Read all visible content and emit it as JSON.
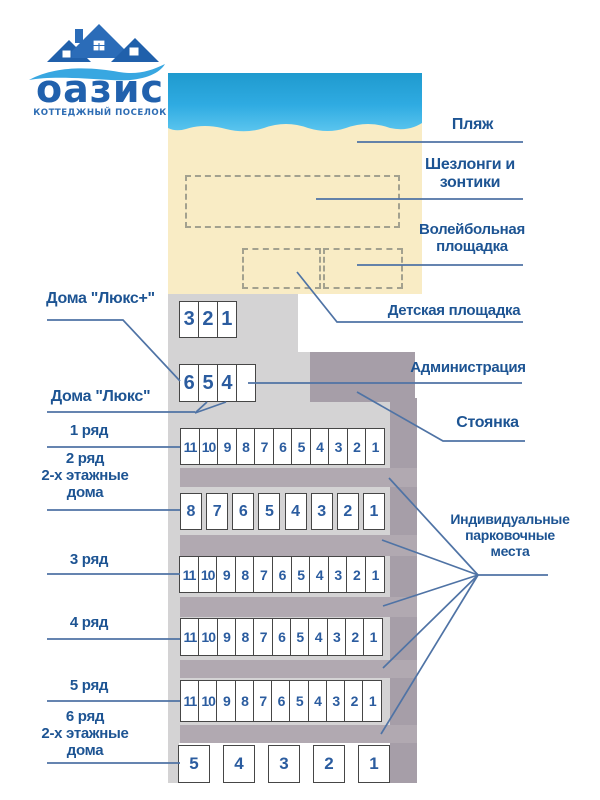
{
  "logo": {
    "brand": "оазис",
    "tagline": "КОТТЕДЖНЫЙ ПОСЕЛОК"
  },
  "legend_right": {
    "beach": "Пляж",
    "loungers": "Шезлонги и\nзонтики",
    "volleyball": "Волейбольная\nплощадка",
    "playground": "Детская площадка",
    "administration": "Администрация",
    "parking": "Стоянка",
    "individual_parking": "Индивидуальные\nпарковочные\nместа"
  },
  "legend_left": {
    "lux_plus": "Дома \"Люкс+\"",
    "lux": "Дома \"Люкс\"",
    "row1": "1 ряд",
    "row2": "2 ряд\n2-х этажные\nдома",
    "row3": "3 ряд",
    "row4": "4 ряд",
    "row5": "5 ряд",
    "row6": "6 ряд\n2-х этажные\nдома"
  },
  "house_rows": {
    "lux_plus": [
      "3",
      "2",
      "1"
    ],
    "lux": [
      "6",
      "5",
      "4",
      ""
    ],
    "row1": [
      "11",
      "10",
      "9",
      "8",
      "7",
      "6",
      "5",
      "4",
      "3",
      "2",
      "1"
    ],
    "row2": [
      "8",
      "7",
      "6",
      "5",
      "4",
      "3",
      "2",
      "1"
    ],
    "row3": [
      "11",
      "10",
      "9",
      "8",
      "7",
      "6",
      "5",
      "4",
      "3",
      "2",
      "1"
    ],
    "row4": [
      "11",
      "10",
      "9",
      "8",
      "7",
      "6",
      "5",
      "4",
      "3",
      "2",
      "1"
    ],
    "row5": [
      "11",
      "10",
      "9",
      "8",
      "7",
      "6",
      "5",
      "4",
      "3",
      "2",
      "1"
    ],
    "row6": [
      "5",
      "4",
      "3",
      "2",
      "1"
    ]
  },
  "colors": {
    "label_text": "#1d5493",
    "leader_line": "#4f73a5",
    "house_number": "#2b5c9f",
    "water_top": "#1f9ace",
    "water_bottom": "#5ac5ee",
    "sand": "#f9ecc5",
    "ground_light": "#d4d3d4",
    "road_mauve": "#b1a9b1",
    "logo_blue": "#2161ad"
  }
}
